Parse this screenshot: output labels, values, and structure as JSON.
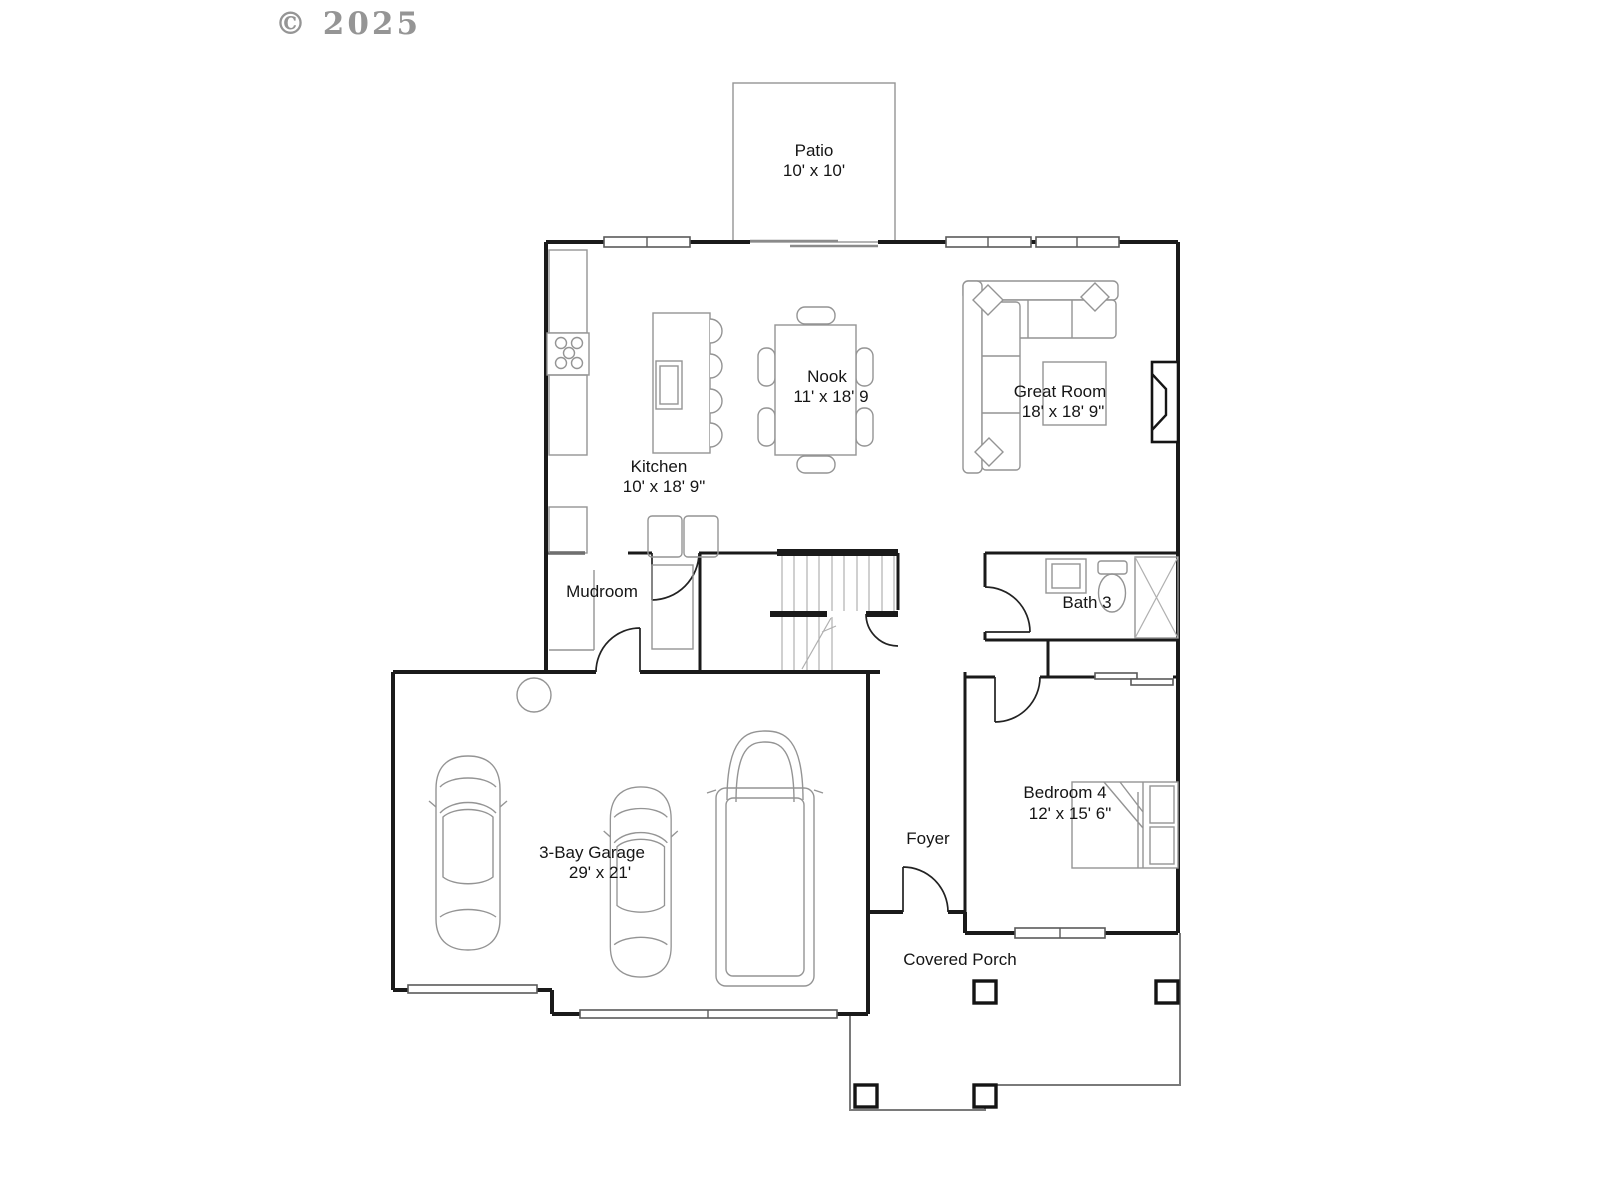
{
  "watermark": "© 2025",
  "labels": {
    "patio": {
      "name": "Patio",
      "dims": "10' x 10'"
    },
    "kitchen": {
      "name": "Kitchen",
      "dims": "10' x 18' 9\""
    },
    "nook": {
      "name": "Nook",
      "dims": "11' x 18' 9"
    },
    "great_room": {
      "name": "Great Room",
      "dims": "18' x 18' 9\""
    },
    "mudroom": {
      "name": "Mudroom"
    },
    "bath3": {
      "name": "Bath 3"
    },
    "garage": {
      "name": "3-Bay Garage",
      "dims": "29' x 21'"
    },
    "foyer": {
      "name": "Foyer"
    },
    "bedroom4": {
      "name": "Bedroom 4",
      "dims": "12' x 15' 6\""
    },
    "covered_porch": {
      "name": "Covered Porch"
    }
  },
  "colors": {
    "background": "#ffffff",
    "wall": "#1a1a1a",
    "furniture": "#949494",
    "porch": "#7a7a7a",
    "watermark": "#8a8a8a"
  }
}
